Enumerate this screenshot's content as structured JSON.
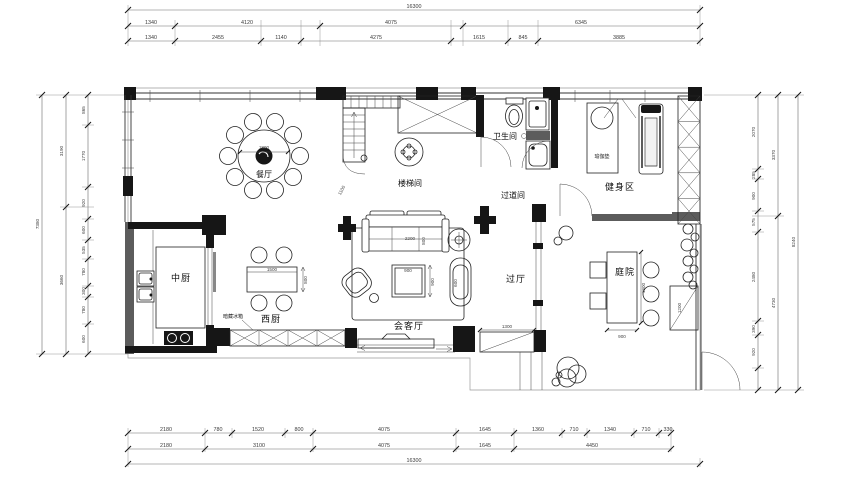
{
  "drawing": {
    "rooms": {
      "dining": "餐厅",
      "stair": "楼梯间",
      "bath": "卫生间",
      "corridor": "过道间",
      "gym": "健身区",
      "kitchen_cn": "中厨",
      "kitchen_west": "西厨",
      "living": "会客厅",
      "hall": "过厅",
      "courtyard": "庭院"
    },
    "notes": {
      "hidden_fridge": "暗藏冰箱",
      "yoga_mat": "瑜伽垫"
    },
    "furniture_dims": {
      "dining_table": "1800",
      "dining_offset": "1100",
      "west_table_w": "1500",
      "west_table_d": "800",
      "sofa_w": "2200",
      "sofa_d": "800",
      "coffee_w": "900",
      "coffee_d": "900",
      "lounge_w": "600",
      "hall_window": "1300",
      "yard_table_l": "1800",
      "yard_table_w": "900",
      "gate": "1200"
    }
  },
  "dims": {
    "top": {
      "overall": "16300",
      "row2": [
        "1340",
        "4120",
        "4075",
        "6345"
      ],
      "row3": [
        "1340",
        "2455",
        "1140",
        "4275",
        "1615",
        "845",
        "3885"
      ]
    },
    "bottom": {
      "overall": "16300",
      "row1": [
        "2180",
        "780",
        "1520",
        "800",
        "4075",
        "1645",
        "1360",
        "710",
        "1340",
        "710",
        "330"
      ],
      "row2": [
        "2180",
        "3100",
        "4075",
        "1645",
        "4450"
      ]
    },
    "left": {
      "overall": "7380",
      "mid": [
        "3190",
        "3660"
      ],
      "inner": [
        "865",
        "1770",
        "920",
        "600",
        "535",
        "780",
        "300",
        "780",
        "600"
      ]
    },
    "right": {
      "overall": "8240",
      "mid": [
        "3370",
        "4730"
      ],
      "inner": [
        "2070",
        "285",
        "900",
        "575",
        "2480",
        "390",
        "920"
      ]
    }
  }
}
